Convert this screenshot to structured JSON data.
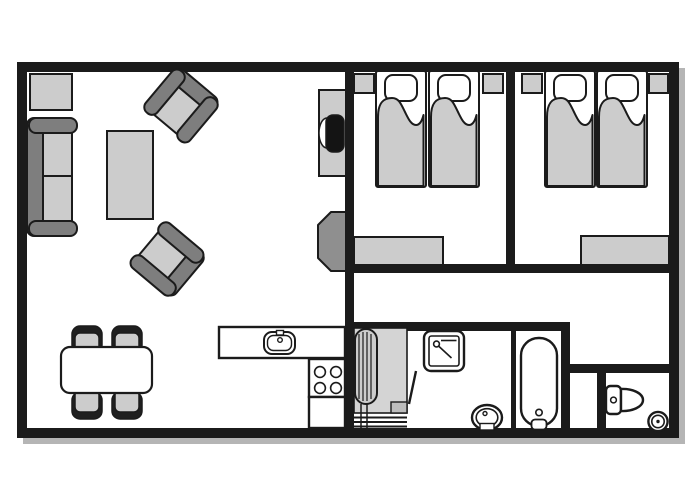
{
  "plan": {
    "kind": "apartment-floor-plan",
    "text_labels": [],
    "colors": {
      "white": "#ffffff",
      "outline": "#1b1b1b",
      "wall": "#1b1b1b",
      "light": "#cccccc",
      "mid": "#d4d4d4",
      "dark": "#7e7e7e",
      "dark2": "#8f8f8f",
      "cap": "#1f1f1f",
      "tv": "#141414",
      "step": "#bdbdbd",
      "shadow": "#b5b5b5"
    },
    "rooms": [
      {
        "id": "living-room",
        "furniture": [
          "side-table",
          "sofa-2-seat",
          "coffee-table",
          "armchair",
          "armchair",
          "tv-stand",
          "tv",
          "fireplace"
        ]
      },
      {
        "id": "dining-area",
        "furniture": [
          "dining-table",
          "chair",
          "chair",
          "chair",
          "chair"
        ]
      },
      {
        "id": "kitchen",
        "furniture": [
          "counter-with-sink",
          "stove-4-burners",
          "lower-counter"
        ]
      },
      {
        "id": "bedroom-1",
        "furniture": [
          "nightstand",
          "twin-bed",
          "twin-bed",
          "nightstand",
          "dresser"
        ]
      },
      {
        "id": "bedroom-2",
        "furniture": [
          "nightstand",
          "twin-bed",
          "twin-bed",
          "nightstand",
          "dresser"
        ]
      },
      {
        "id": "hallway",
        "furniture": []
      },
      {
        "id": "entry-utility",
        "furniture": [
          "radiator",
          "closet-area",
          "floor-step",
          "door-leaf"
        ]
      },
      {
        "id": "bathroom",
        "furniture": [
          "shower-unit",
          "washbasin",
          "bathtub"
        ]
      },
      {
        "id": "wc",
        "furniture": [
          "toilet",
          "corner-basin"
        ]
      }
    ]
  }
}
